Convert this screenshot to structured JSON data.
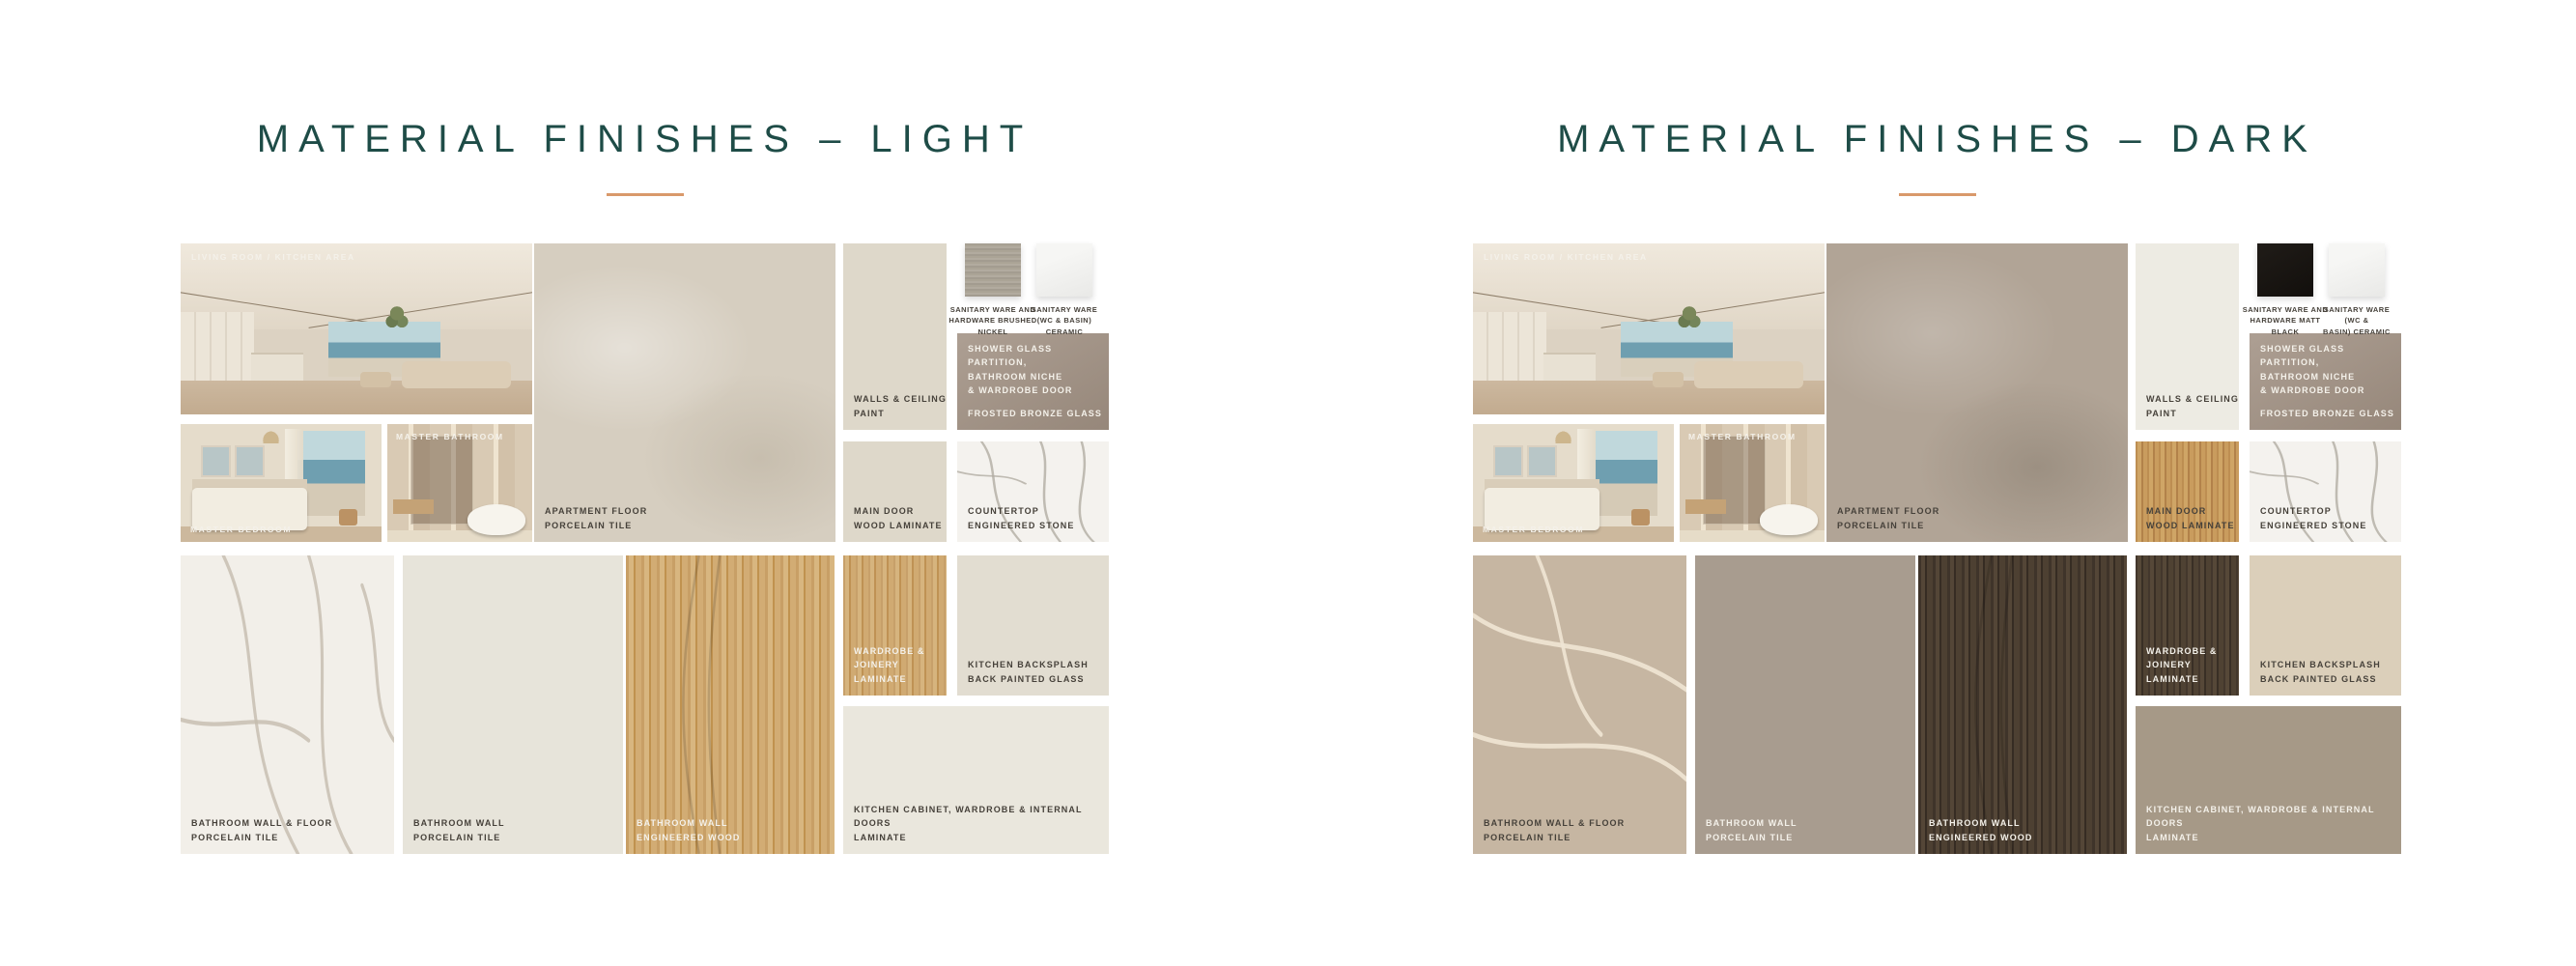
{
  "page": {
    "background": "#ffffff"
  },
  "accents": {
    "title_color": "#1e4c47",
    "underline_color": "#d9996b",
    "label_dark": "#46413a",
    "label_light": "#f4f1ea"
  },
  "boards": [
    {
      "theme": "light",
      "title": "MATERIAL FINISHES – LIGHT",
      "captions": {
        "living": "LIVING ROOM / KITCHEN AREA",
        "bedroom": "MASTER BEDROOM",
        "bathroom": "MASTER BATHROOM"
      },
      "labels": {
        "apartment_floor": "APARTMENT FLOOR\nPORCELAIN TILE",
        "walls_paint": "WALLS & CEILING\nPAINT",
        "sanitary_hardware": "SANITARY WARE AND\nHARDWARE BRUSHED\nNICKEL",
        "sanitary_ceramic": "SANITARY WARE\n(WC & BASIN)\nCERAMIC",
        "shower_usage": "SHOWER GLASS PARTITION,\nBATHROOM NICHE\n& WARDROBE DOOR",
        "shower_material": "FROSTED BRONZE GLASS",
        "main_door": "MAIN DOOR\nWOOD LAMINATE",
        "countertop": "COUNTERTOP\nENGINEERED STONE",
        "bathroom_wall_floor": "BATHROOM WALL & FLOOR\nPORCELAIN TILE",
        "bathroom_wall": "BATHROOM WALL\nPORCELAIN TILE",
        "bathroom_wood": "BATHROOM WALL\nENGINEERED WOOD",
        "wardrobe": "WARDROBE & JOINERY\nLAMINATE",
        "backsplash": "KITCHEN BACKSPLASH\nBACK PAINTED GLASS",
        "kitchen_cabinet": "KITCHEN CABINET,  WARDROBE & INTERNAL DOORS\nLAMINATE"
      },
      "swatch_colors": {
        "apartment_floor": "#d6cec0",
        "walls_paint": "#ded8ca",
        "sanitary_hardware": "#a8a196",
        "sanitary_ceramic": "#f2f2f0",
        "frosted_bronze": "#a29487",
        "main_door": "#ded8ca",
        "countertop": "#f4f2ee",
        "bathroom_wall_floor": "#f2efe9",
        "bathroom_wall": "#e7e4da",
        "bathroom_wood": "#cfa976",
        "wardrobe": "#cda671",
        "backsplash": "#e2ddd1",
        "kitchen_cabinet": "#eae7dd"
      }
    },
    {
      "theme": "dark",
      "title": "MATERIAL FINISHES – DARK",
      "captions": {
        "living": "LIVING ROOM / KITCHEN AREA",
        "bedroom": "MASTER BEDROOM",
        "bathroom": "MASTER BATHROOM"
      },
      "labels": {
        "apartment_floor": "APARTMENT FLOOR\nPORCELAIN TILE",
        "walls_paint": "WALLS & CEILING\nPAINT",
        "sanitary_hardware": "SANITARY WARE AND\nHARDWARE MATT BLACK",
        "sanitary_ceramic": "SANITARY WARE (WC &\nBASIN) CERAMIC",
        "shower_usage": "SHOWER GLASS PARTITION,\nBATHROOM NICHE\n& WARDROBE DOOR",
        "shower_material": "FROSTED BRONZE GLASS",
        "main_door": "MAIN DOOR\nWOOD LAMINATE",
        "countertop": "COUNTERTOP\nENGINEERED STONE",
        "bathroom_wall_floor": "BATHROOM WALL & FLOOR\nPORCELAIN TILE",
        "bathroom_wall": "BATHROOM WALL\nPORCELAIN TILE",
        "bathroom_wood": "BATHROOM WALL\nENGINEERED WOOD",
        "wardrobe": "WARDROBE & JOINERY\nLAMINATE",
        "backsplash": "KITCHEN BACKSPLASH\nBACK PAINTED GLASS",
        "kitchen_cabinet": "KITCHEN CABINET,  WARDROBE & INTERNAL DOORS\nLAMINATE"
      },
      "swatch_colors": {
        "apartment_floor": "#b1a496",
        "walls_paint": "#edebe3",
        "sanitary_hardware": "#171310",
        "sanitary_ceramic": "#f2f2f0",
        "frosted_bronze": "#a29487",
        "main_door": "#c59c5e",
        "countertop": "#f4f2ee",
        "bathroom_wall_floor": "#c6b6a2",
        "bathroom_wall": "#a89c8f",
        "bathroom_wood": "#4a3d31",
        "wardrobe": "#4a3d31",
        "backsplash": "#dbcfba",
        "kitchen_cabinet": "#a69987"
      }
    }
  ]
}
